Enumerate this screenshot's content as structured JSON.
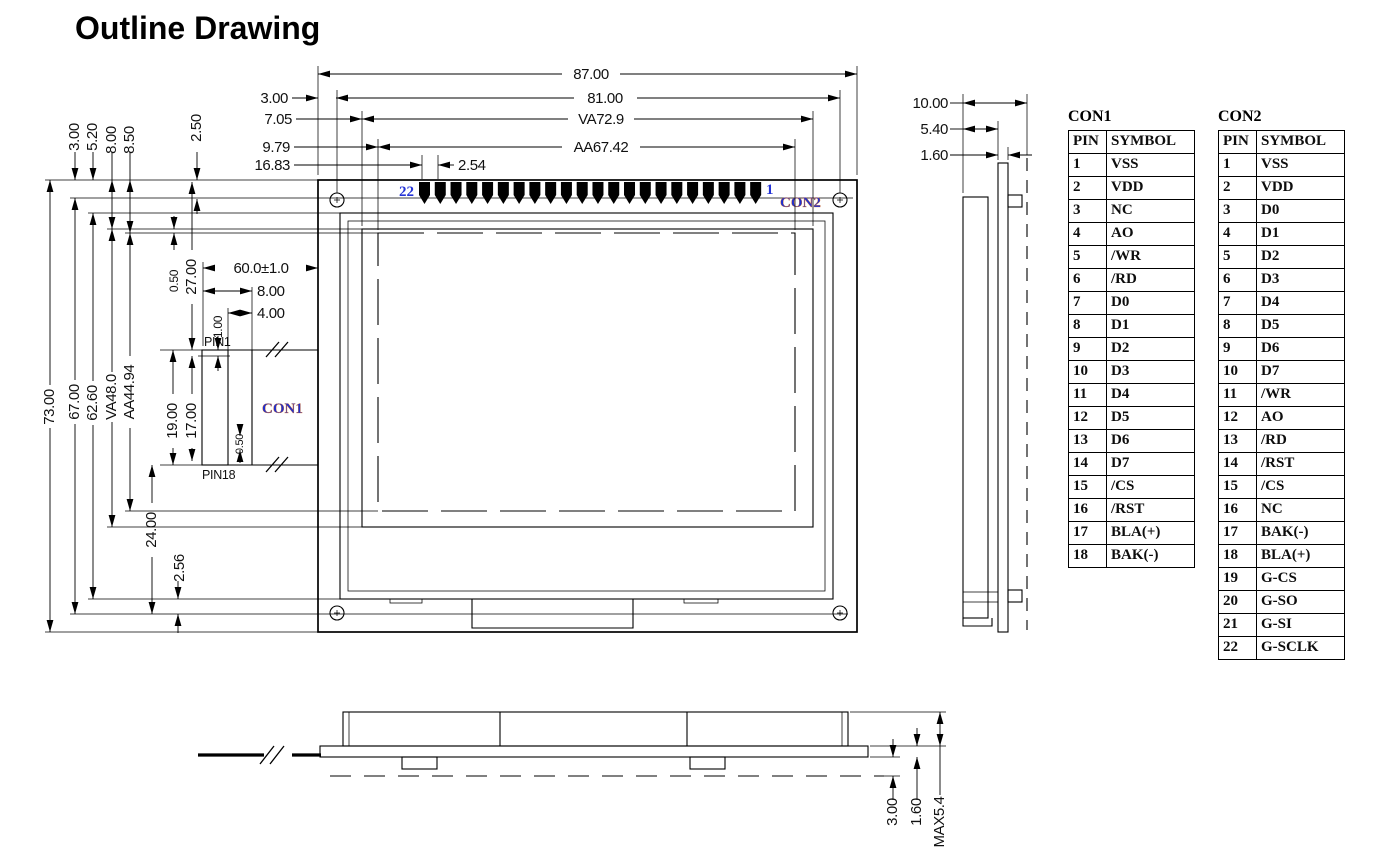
{
  "title": "Outline Drawing",
  "colors": {
    "line": "#000000",
    "label_blue": "#1f2fd0",
    "label_fringe": "#d4691e"
  },
  "front_view": {
    "pin_count": 22,
    "labels": {
      "pin_left": "22",
      "pin_right": "1",
      "con2": "CON2",
      "con1": "CON1",
      "pin1": "PIN1",
      "pin18": "PIN18"
    },
    "dims_top": {
      "overall_width": "87.00",
      "hole_edge_offset": "3.00",
      "hole_span": "81.00",
      "va_left_offset": "7.05",
      "va_width": "VA72.9",
      "aa_left_offset": "9.79",
      "aa_width": "AA67.42",
      "pad_left_offset": "16.83",
      "pad_pitch": "2.54",
      "hole_top_offset": "2.50"
    },
    "dims_left": {
      "pad_row_offset": "3.00",
      "bezel_top_offset": "5.20",
      "va_top_offset": "8.00",
      "aa_top_offset": "8.50",
      "overall_height": "73.00",
      "pad_to_bottom_hole": "67.00",
      "bezel_height": "62.60",
      "va_height": "VA48.0",
      "aa_height": "AA44.94",
      "top_to_pin1": "27.00",
      "gap_small_a": "0.50",
      "pin1_inset": "1.00",
      "con1_pin_span": "19.00",
      "con1_pin_span_inner": "17.00",
      "pin_pitch_small": "0.50",
      "pin18_to_hole": "24.00",
      "bezel_to_hole": "2.56"
    },
    "dims_con1": {
      "fpc_length": "60.0±1.0",
      "fpc_width_outer": "8.00",
      "fpc_width_inner": "4.00"
    }
  },
  "side_view": {
    "dims": {
      "total_depth": "10.00",
      "display_depth": "5.40",
      "pcb_thickness": "1.60"
    }
  },
  "bottom_view": {
    "dims": {
      "clearance": "3.00",
      "pcb_thickness": "1.60",
      "max_height": "MAX5.4"
    }
  },
  "tables": {
    "con1": {
      "title": "CON1",
      "headers": [
        "PIN",
        "SYMBOL"
      ],
      "rows": [
        [
          "1",
          "VSS"
        ],
        [
          "2",
          "VDD"
        ],
        [
          "3",
          "NC"
        ],
        [
          "4",
          "AO"
        ],
        [
          "5",
          "/WR"
        ],
        [
          "6",
          "/RD"
        ],
        [
          "7",
          "D0"
        ],
        [
          "8",
          "D1"
        ],
        [
          "9",
          "D2"
        ],
        [
          "10",
          "D3"
        ],
        [
          "11",
          "D4"
        ],
        [
          "12",
          "D5"
        ],
        [
          "13",
          "D6"
        ],
        [
          "14",
          "D7"
        ],
        [
          "15",
          "/CS"
        ],
        [
          "16",
          "/RST"
        ],
        [
          "17",
          "BLA(+)"
        ],
        [
          "18",
          "BAK(-)"
        ]
      ]
    },
    "con2": {
      "title": "CON2",
      "headers": [
        "PIN",
        "SYMBOL"
      ],
      "rows": [
        [
          "1",
          "VSS"
        ],
        [
          "2",
          "VDD"
        ],
        [
          "3",
          "D0"
        ],
        [
          "4",
          "D1"
        ],
        [
          "5",
          "D2"
        ],
        [
          "6",
          "D3"
        ],
        [
          "7",
          "D4"
        ],
        [
          "8",
          "D5"
        ],
        [
          "9",
          "D6"
        ],
        [
          "10",
          "D7"
        ],
        [
          "11",
          "/WR"
        ],
        [
          "12",
          "AO"
        ],
        [
          "13",
          "/RD"
        ],
        [
          "14",
          "/RST"
        ],
        [
          "15",
          "/CS"
        ],
        [
          "16",
          "NC"
        ],
        [
          "17",
          "BAK(-)"
        ],
        [
          "18",
          "BLA(+)"
        ],
        [
          "19",
          "G-CS"
        ],
        [
          "20",
          "G-SO"
        ],
        [
          "21",
          "G-SI"
        ],
        [
          "22",
          "G-SCLK"
        ]
      ]
    }
  }
}
